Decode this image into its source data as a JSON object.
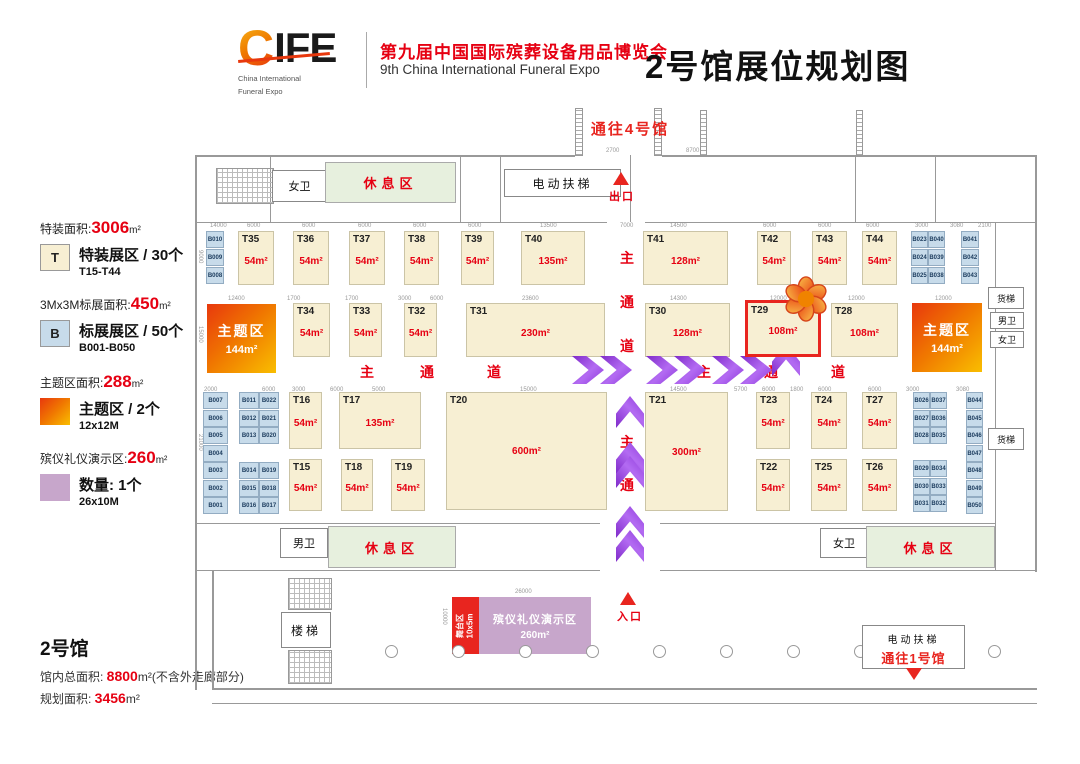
{
  "header": {
    "logo_c": "C",
    "logo_rest": "IFE",
    "logo_sub1": "China International",
    "logo_sub2": "Funeral Expo",
    "event_cn": "第九届中国国际殡葬设备用品博览会",
    "event_en": "9th China International Funeral Expo",
    "page_title": "2号馆展位规划图"
  },
  "legend": {
    "items": [
      {
        "heading_prefix": "特装面积:",
        "heading_value": "3006",
        "heading_unit": "m²",
        "swatch_label": "T",
        "line1": "特装展区 / 30个",
        "line2": "T15-T44"
      },
      {
        "heading_prefix": "3Mx3M标展面积:",
        "heading_value": "450",
        "heading_unit": "m²",
        "swatch_label": "B",
        "line1": "标展展区 / 50个",
        "line2": "B001-B050"
      },
      {
        "heading_prefix": "主题区面积:",
        "heading_value": "288",
        "heading_unit": "m²",
        "swatch_label": "",
        "line1": "主题区 / 2个",
        "line2": "12x12M"
      },
      {
        "heading_prefix": "殡仪礼仪演示区:",
        "heading_value": "260",
        "heading_unit": "m²",
        "swatch_label": "",
        "line1": "数量: 1个",
        "line2": "26x10M"
      }
    ]
  },
  "info": {
    "hall": "2号馆",
    "line1_label": "馆内总面积: ",
    "line1_value": "8800",
    "line1_suffix": "m²(不含外走廊部分)",
    "line2_label": "规划面积: ",
    "line2_value": "3456",
    "line2_suffix": "m²"
  },
  "colors": {
    "accent_red": "#E60012",
    "highlight_red": "#E8251F",
    "booth_special_fill": "#F7EFD3",
    "booth_standard_fill": "#C7DBEA",
    "theme_gradient_start": "#E8380D",
    "theme_gradient_end": "#F9BE00",
    "demo_purple": "#C7A6CB",
    "rest_green": "#E7F0DE",
    "arrow_purple": "#9B3FE8"
  },
  "floor": {
    "t_booths": [
      {
        "id": "T35",
        "area": "54m²",
        "x": 238,
        "y": 231,
        "w": 36,
        "h": 54
      },
      {
        "id": "T36",
        "area": "54m²",
        "x": 293,
        "y": 231,
        "w": 36,
        "h": 54
      },
      {
        "id": "T37",
        "area": "54m²",
        "x": 349,
        "y": 231,
        "w": 36,
        "h": 54
      },
      {
        "id": "T38",
        "area": "54m²",
        "x": 404,
        "y": 231,
        "w": 35,
        "h": 54
      },
      {
        "id": "T39",
        "area": "54m²",
        "x": 461,
        "y": 231,
        "w": 33,
        "h": 54
      },
      {
        "id": "T40",
        "area": "135m²",
        "x": 521,
        "y": 231,
        "w": 64,
        "h": 54
      },
      {
        "id": "T41",
        "area": "128m²",
        "x": 643,
        "y": 231,
        "w": 85,
        "h": 54
      },
      {
        "id": "T42",
        "area": "54m²",
        "x": 757,
        "y": 231,
        "w": 34,
        "h": 54
      },
      {
        "id": "T43",
        "area": "54m²",
        "x": 812,
        "y": 231,
        "w": 35,
        "h": 54
      },
      {
        "id": "T44",
        "area": "54m²",
        "x": 862,
        "y": 231,
        "w": 35,
        "h": 54
      },
      {
        "id": "T34",
        "area": "54m²",
        "x": 293,
        "y": 303,
        "w": 37,
        "h": 54
      },
      {
        "id": "T33",
        "area": "54m²",
        "x": 349,
        "y": 303,
        "w": 33,
        "h": 54
      },
      {
        "id": "T32",
        "area": "54m²",
        "x": 404,
        "y": 303,
        "w": 33,
        "h": 54
      },
      {
        "id": "T31",
        "area": "230m²",
        "x": 466,
        "y": 303,
        "w": 139,
        "h": 54
      },
      {
        "id": "T30",
        "area": "128m²",
        "x": 645,
        "y": 303,
        "w": 85,
        "h": 54
      },
      {
        "id": "T29",
        "area": "108m²",
        "x": 745,
        "y": 300,
        "w": 76,
        "h": 57,
        "highlight": true
      },
      {
        "id": "T28",
        "area": "108m²",
        "x": 831,
        "y": 303,
        "w": 67,
        "h": 54
      },
      {
        "id": "T16",
        "area": "54m²",
        "x": 289,
        "y": 392,
        "w": 33,
        "h": 57
      },
      {
        "id": "T17",
        "area": "135m²",
        "x": 339,
        "y": 392,
        "w": 82,
        "h": 57
      },
      {
        "id": "T20",
        "area": "600m²",
        "x": 446,
        "y": 392,
        "w": 161,
        "h": 118
      },
      {
        "id": "T21",
        "area": "300m²",
        "x": 645,
        "y": 392,
        "w": 83,
        "h": 119
      },
      {
        "id": "T23",
        "area": "54m²",
        "x": 756,
        "y": 392,
        "w": 34,
        "h": 57
      },
      {
        "id": "T24",
        "area": "54m²",
        "x": 811,
        "y": 392,
        "w": 36,
        "h": 57
      },
      {
        "id": "T27",
        "area": "54m²",
        "x": 862,
        "y": 392,
        "w": 35,
        "h": 57
      },
      {
        "id": "T15",
        "area": "54m²",
        "x": 289,
        "y": 459,
        "w": 33,
        "h": 52
      },
      {
        "id": "T18",
        "area": "54m²",
        "x": 341,
        "y": 459,
        "w": 32,
        "h": 52
      },
      {
        "id": "T19",
        "area": "54m²",
        "x": 391,
        "y": 459,
        "w": 34,
        "h": 52
      },
      {
        "id": "T22",
        "area": "54m²",
        "x": 756,
        "y": 459,
        "w": 34,
        "h": 52
      },
      {
        "id": "T25",
        "area": "54m²",
        "x": 811,
        "y": 459,
        "w": 36,
        "h": 52
      },
      {
        "id": "T26",
        "area": "54m²",
        "x": 862,
        "y": 459,
        "w": 35,
        "h": 52
      }
    ],
    "b_booths": [
      {
        "id": "B010",
        "x": 206,
        "y": 231,
        "w": 18
      },
      {
        "id": "B009",
        "x": 206,
        "y": 249,
        "w": 18
      },
      {
        "id": "B008",
        "x": 206,
        "y": 267,
        "w": 18
      },
      {
        "id": "B007",
        "x": 203,
        "y": 392,
        "w": 25
      },
      {
        "id": "B006",
        "x": 203,
        "y": 410,
        "w": 25
      },
      {
        "id": "B005",
        "x": 203,
        "y": 427,
        "w": 25
      },
      {
        "id": "B004",
        "x": 203,
        "y": 445,
        "w": 25
      },
      {
        "id": "B003",
        "x": 203,
        "y": 462,
        "w": 25
      },
      {
        "id": "B002",
        "x": 203,
        "y": 480,
        "w": 25
      },
      {
        "id": "B001",
        "x": 203,
        "y": 497,
        "w": 25
      },
      {
        "id": "B011",
        "x": 239,
        "y": 392,
        "w": 20
      },
      {
        "id": "B022",
        "x": 259,
        "y": 392,
        "w": 20
      },
      {
        "id": "B012",
        "x": 239,
        "y": 410,
        "w": 20
      },
      {
        "id": "B021",
        "x": 259,
        "y": 410,
        "w": 20
      },
      {
        "id": "B013",
        "x": 239,
        "y": 427,
        "w": 20
      },
      {
        "id": "B020",
        "x": 259,
        "y": 427,
        "w": 20
      },
      {
        "id": "B014",
        "x": 239,
        "y": 462,
        "w": 20
      },
      {
        "id": "B019",
        "x": 259,
        "y": 462,
        "w": 20
      },
      {
        "id": "B015",
        "x": 239,
        "y": 480,
        "w": 20
      },
      {
        "id": "B018",
        "x": 259,
        "y": 480,
        "w": 20
      },
      {
        "id": "B016",
        "x": 239,
        "y": 497,
        "w": 20
      },
      {
        "id": "B017",
        "x": 259,
        "y": 497,
        "w": 20
      },
      {
        "id": "B023",
        "x": 911,
        "y": 231,
        "w": 17
      },
      {
        "id": "B040",
        "x": 928,
        "y": 231,
        "w": 17
      },
      {
        "id": "B024",
        "x": 911,
        "y": 249,
        "w": 17
      },
      {
        "id": "B039",
        "x": 928,
        "y": 249,
        "w": 17
      },
      {
        "id": "B025",
        "x": 911,
        "y": 267,
        "w": 17
      },
      {
        "id": "B038",
        "x": 928,
        "y": 267,
        "w": 17
      },
      {
        "id": "B041",
        "x": 961,
        "y": 231,
        "w": 18
      },
      {
        "id": "B042",
        "x": 961,
        "y": 249,
        "w": 18
      },
      {
        "id": "B043",
        "x": 961,
        "y": 267,
        "w": 18
      },
      {
        "id": "B026",
        "x": 913,
        "y": 392,
        "w": 17
      },
      {
        "id": "B037",
        "x": 930,
        "y": 392,
        "w": 17
      },
      {
        "id": "B027",
        "x": 913,
        "y": 410,
        "w": 17
      },
      {
        "id": "B036",
        "x": 930,
        "y": 410,
        "w": 17
      },
      {
        "id": "B028",
        "x": 913,
        "y": 427,
        "w": 17
      },
      {
        "id": "B035",
        "x": 930,
        "y": 427,
        "w": 17
      },
      {
        "id": "B029",
        "x": 913,
        "y": 460,
        "w": 17
      },
      {
        "id": "B034",
        "x": 930,
        "y": 460,
        "w": 17
      },
      {
        "id": "B030",
        "x": 913,
        "y": 478,
        "w": 17
      },
      {
        "id": "B033",
        "x": 930,
        "y": 478,
        "w": 17
      },
      {
        "id": "B031",
        "x": 913,
        "y": 495,
        "w": 17
      },
      {
        "id": "B032",
        "x": 930,
        "y": 495,
        "w": 17
      },
      {
        "id": "B044",
        "x": 966,
        "y": 392,
        "w": 17
      },
      {
        "id": "B045",
        "x": 966,
        "y": 410,
        "w": 17
      },
      {
        "id": "B046",
        "x": 966,
        "y": 427,
        "w": 17
      },
      {
        "id": "B047",
        "x": 966,
        "y": 445,
        "w": 17
      },
      {
        "id": "B048",
        "x": 966,
        "y": 462,
        "w": 17
      },
      {
        "id": "B049",
        "x": 966,
        "y": 480,
        "w": 17
      },
      {
        "id": "B050",
        "x": 966,
        "y": 497,
        "w": 17
      }
    ],
    "theme_zones": [
      {
        "label": "主题区",
        "area": "144m²",
        "x": 207,
        "y": 304,
        "w": 69,
        "h": 69
      },
      {
        "label": "主题区",
        "area": "144m²",
        "x": 912,
        "y": 303,
        "w": 70,
        "h": 69
      }
    ],
    "rooms": [
      {
        "name": "wc-women-top",
        "label": "女卫",
        "x": 272,
        "y": 170,
        "w": 55,
        "h": 32
      },
      {
        "name": "rest-area-top",
        "label": "休息区",
        "style": "green",
        "x": 325,
        "y": 162,
        "w": 131,
        "h": 41
      },
      {
        "name": "escalator-top",
        "label": "电动扶梯",
        "style": "sp",
        "x": 504,
        "y": 169,
        "w": 117,
        "h": 28
      },
      {
        "name": "freight-elevator-top-right",
        "label": "货梯",
        "style": "small",
        "x": 988,
        "y": 287,
        "w": 36,
        "h": 22
      },
      {
        "name": "wc-men-right",
        "label": "男卫",
        "style": "small",
        "x": 990,
        "y": 312,
        "w": 34,
        "h": 17
      },
      {
        "name": "wc-women-right",
        "label": "女卫",
        "style": "small",
        "x": 990,
        "y": 331,
        "w": 34,
        "h": 17
      },
      {
        "name": "freight-elevator-right",
        "label": "货梯",
        "style": "small",
        "x": 988,
        "y": 428,
        "w": 36,
        "h": 22
      },
      {
        "name": "wc-men-bottom",
        "label": "男卫",
        "x": 280,
        "y": 528,
        "w": 48,
        "h": 30
      },
      {
        "name": "rest-area-bottom-left",
        "label": "休息区",
        "style": "green",
        "x": 328,
        "y": 526,
        "w": 128,
        "h": 42
      },
      {
        "name": "wc-women-bottom",
        "label": "女卫",
        "x": 820,
        "y": 528,
        "w": 48,
        "h": 30
      },
      {
        "name": "rest-area-bottom-right",
        "label": "休息区",
        "style": "green",
        "x": 866,
        "y": 526,
        "w": 129,
        "h": 42
      },
      {
        "name": "stairs",
        "label": "楼梯",
        "style": "sp",
        "x": 281,
        "y": 612,
        "w": 50,
        "h": 36
      }
    ],
    "stage": {
      "label": "舞台区",
      "size": "10x5m"
    },
    "demo": {
      "label": "殡仪礼仪演示区",
      "area": "260m²"
    },
    "escalator_south": {
      "line1": "电动扶梯",
      "line2": "通往1号馆"
    },
    "markers": {
      "to_hall4": "通往4号馆",
      "exit": "出口",
      "entrance": "入口"
    },
    "aisle_chars": [
      {
        "t": "主",
        "x": 360,
        "y": 362
      },
      {
        "t": "通",
        "x": 420,
        "y": 362
      },
      {
        "t": "道",
        "x": 487,
        "y": 362
      },
      {
        "t": "主",
        "x": 697,
        "y": 362
      },
      {
        "t": "通",
        "x": 764,
        "y": 362
      },
      {
        "t": "道",
        "x": 831,
        "y": 362
      },
      {
        "t": "主",
        "x": 620,
        "y": 248
      },
      {
        "t": "通",
        "x": 620,
        "y": 292
      },
      {
        "t": "道",
        "x": 620,
        "y": 336
      },
      {
        "t": "主",
        "x": 620,
        "y": 432
      },
      {
        "t": "通",
        "x": 620,
        "y": 475
      }
    ],
    "arrows": [
      {
        "x": 572,
        "y": 356,
        "d": "r"
      },
      {
        "x": 600,
        "y": 356,
        "d": "r"
      },
      {
        "x": 646,
        "y": 356,
        "d": "r"
      },
      {
        "x": 674,
        "y": 356,
        "d": "r"
      },
      {
        "x": 712,
        "y": 356,
        "d": "r"
      },
      {
        "x": 740,
        "y": 356,
        "d": "r"
      },
      {
        "x": 770,
        "y": 346,
        "d": "u"
      },
      {
        "x": 614,
        "y": 398,
        "d": "u"
      },
      {
        "x": 614,
        "y": 444,
        "d": "u"
      },
      {
        "x": 614,
        "y": 458,
        "d": "u"
      },
      {
        "x": 614,
        "y": 508,
        "d": "u"
      },
      {
        "x": 614,
        "y": 532,
        "d": "u"
      }
    ],
    "dims": [
      {
        "t": "2700",
        "x": 606,
        "y": 148
      },
      {
        "t": "8700",
        "x": 686,
        "y": 148
      },
      {
        "t": "14000",
        "x": 210,
        "y": 223
      },
      {
        "t": "6000",
        "x": 247,
        "y": 223
      },
      {
        "t": "6000",
        "x": 302,
        "y": 223
      },
      {
        "t": "6000",
        "x": 358,
        "y": 223
      },
      {
        "t": "6000",
        "x": 413,
        "y": 223
      },
      {
        "t": "6000",
        "x": 468,
        "y": 223
      },
      {
        "t": "13500",
        "x": 540,
        "y": 223
      },
      {
        "t": "7000",
        "x": 620,
        "y": 223
      },
      {
        "t": "14500",
        "x": 670,
        "y": 223
      },
      {
        "t": "6000",
        "x": 763,
        "y": 223
      },
      {
        "t": "6000",
        "x": 818,
        "y": 223
      },
      {
        "t": "6000",
        "x": 866,
        "y": 223
      },
      {
        "t": "3000",
        "x": 915,
        "y": 223
      },
      {
        "t": "3080",
        "x": 950,
        "y": 223
      },
      {
        "t": "2100",
        "x": 978,
        "y": 223
      },
      {
        "t": "12400",
        "x": 228,
        "y": 296
      },
      {
        "t": "1700",
        "x": 287,
        "y": 296
      },
      {
        "t": "1700",
        "x": 345,
        "y": 296
      },
      {
        "t": "3000",
        "x": 398,
        "y": 296
      },
      {
        "t": "6000",
        "x": 430,
        "y": 296
      },
      {
        "t": "23600",
        "x": 522,
        "y": 296
      },
      {
        "t": "14300",
        "x": 670,
        "y": 296
      },
      {
        "t": "12000",
        "x": 770,
        "y": 296
      },
      {
        "t": "12000",
        "x": 848,
        "y": 296
      },
      {
        "t": "12000",
        "x": 935,
        "y": 296
      },
      {
        "t": "2000",
        "x": 204,
        "y": 387
      },
      {
        "t": "6000",
        "x": 262,
        "y": 387
      },
      {
        "t": "3000",
        "x": 292,
        "y": 387
      },
      {
        "t": "6000",
        "x": 330,
        "y": 387
      },
      {
        "t": "5000",
        "x": 372,
        "y": 387
      },
      {
        "t": "15000",
        "x": 520,
        "y": 387
      },
      {
        "t": "14500",
        "x": 670,
        "y": 387
      },
      {
        "t": "5700",
        "x": 734,
        "y": 387
      },
      {
        "t": "6000",
        "x": 762,
        "y": 387
      },
      {
        "t": "1800",
        "x": 790,
        "y": 387
      },
      {
        "t": "6000",
        "x": 818,
        "y": 387
      },
      {
        "t": "6000",
        "x": 868,
        "y": 387
      },
      {
        "t": "3000",
        "x": 906,
        "y": 387
      },
      {
        "t": "3080",
        "x": 956,
        "y": 387
      },
      {
        "t": "26000",
        "x": 515,
        "y": 589
      },
      {
        "t": "10000",
        "x": 441,
        "y": 608,
        "v": true
      },
      {
        "t": "9000",
        "x": 197,
        "y": 250,
        "v": true
      },
      {
        "t": "15000",
        "x": 197,
        "y": 326,
        "v": true
      },
      {
        "t": "21000",
        "x": 197,
        "y": 434,
        "v": true
      }
    ],
    "columns": {
      "y": 645,
      "xs": [
        385,
        452,
        519,
        586,
        653,
        720,
        787,
        854,
        921,
        988
      ]
    }
  }
}
